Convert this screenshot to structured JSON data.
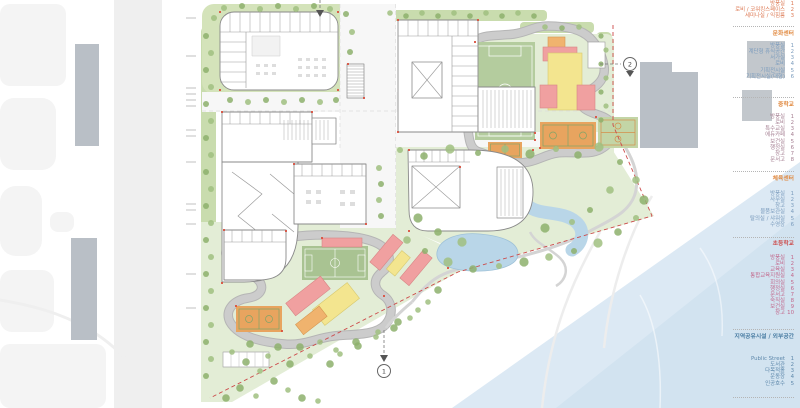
{
  "legend": {
    "sections": [
      {
        "name": "top-partial",
        "header": "",
        "header_color": "",
        "item_color": "#dd7a55",
        "items": [
          [
            "방풍실",
            "1"
          ],
          [
            "로비 / 코워킹스페이스",
            "2"
          ],
          [
            "세미나실 / 익힘룸",
            "3"
          ]
        ]
      },
      {
        "name": "culture-center",
        "header": "문화센터",
        "header_color": "#e0883e",
        "item_color": "#7b9cbd",
        "items": [
          [
            "방풍실",
            "1"
          ],
          [
            "계단형 휴식공간",
            "2"
          ],
          [
            "서가실",
            "3"
          ],
          [
            "로비",
            "4"
          ],
          [
            "기획전시실",
            "5"
          ],
          [
            "기획전시실(대형)",
            "6"
          ]
        ]
      },
      {
        "name": "middle-school",
        "header": "중학교",
        "header_color": "#e0883e",
        "item_color": "#a57f92",
        "items": [
          [
            "방풍실",
            "1"
          ],
          [
            "로비",
            "2"
          ],
          [
            "특수교실",
            "3"
          ],
          [
            "에듀카페",
            "4"
          ],
          [
            "보건실",
            "5"
          ],
          [
            "행정실",
            "6"
          ],
          [
            "창고",
            "7"
          ],
          [
            "문서고",
            "8"
          ]
        ]
      },
      {
        "name": "sports-center",
        "header": "체육센터",
        "header_color": "#e0883e",
        "item_color": "#7b9cbd",
        "items": [
          [
            "방풍실",
            "1"
          ],
          [
            "사무실",
            "2"
          ],
          [
            "창고",
            "3"
          ],
          [
            "물품보관실",
            "4"
          ],
          [
            "탈의실 / 샤워실",
            "5"
          ],
          [
            "수영장",
            "6"
          ]
        ]
      },
      {
        "name": "elementary-school",
        "header": "초등학교",
        "header_color": "#cc4d4d",
        "item_color": "#c2688c",
        "items": [
          [
            "방풍실",
            "1"
          ],
          [
            "로비",
            "2"
          ],
          [
            "교육실",
            "3"
          ],
          [
            "통합교육지원실",
            "4"
          ],
          [
            "회의실",
            "5"
          ],
          [
            "행정실",
            "6"
          ],
          [
            "문서고",
            "7"
          ],
          [
            "숙직실",
            "8"
          ],
          [
            "보건실",
            "9"
          ],
          [
            "창고",
            "10"
          ]
        ]
      },
      {
        "name": "community",
        "header": "지역공유시설 / 외부공간",
        "header_color": "#4a7da3",
        "item_color": "#5e88ab",
        "items": [
          [
            "Public Street",
            "1"
          ],
          [
            "도서관",
            "2"
          ],
          [
            "다목적홀",
            "3"
          ],
          [
            "운동장",
            "4"
          ],
          [
            "인공호수",
            "5"
          ]
        ]
      }
    ]
  },
  "markers": {
    "m1": "1",
    "m2": "2"
  },
  "colors": {
    "water": "#dce9f4",
    "green_strip": "#c9dcae",
    "park_green": "#e3edd6",
    "pitch_green": "#b4cc9e",
    "track_gray": "#c9c9c9",
    "building_red": "#f0a0a0",
    "building_yellow": "#f3e58f",
    "building_orange": "#f0b36e",
    "court_orange": "#e8a45f",
    "gray_building": "#b9bfc6",
    "boundary_red": "#cc4a4a",
    "legend_orange": "#e0883e",
    "legend_blue": "#7b9cbd",
    "legend_pink": "#c2688c"
  }
}
